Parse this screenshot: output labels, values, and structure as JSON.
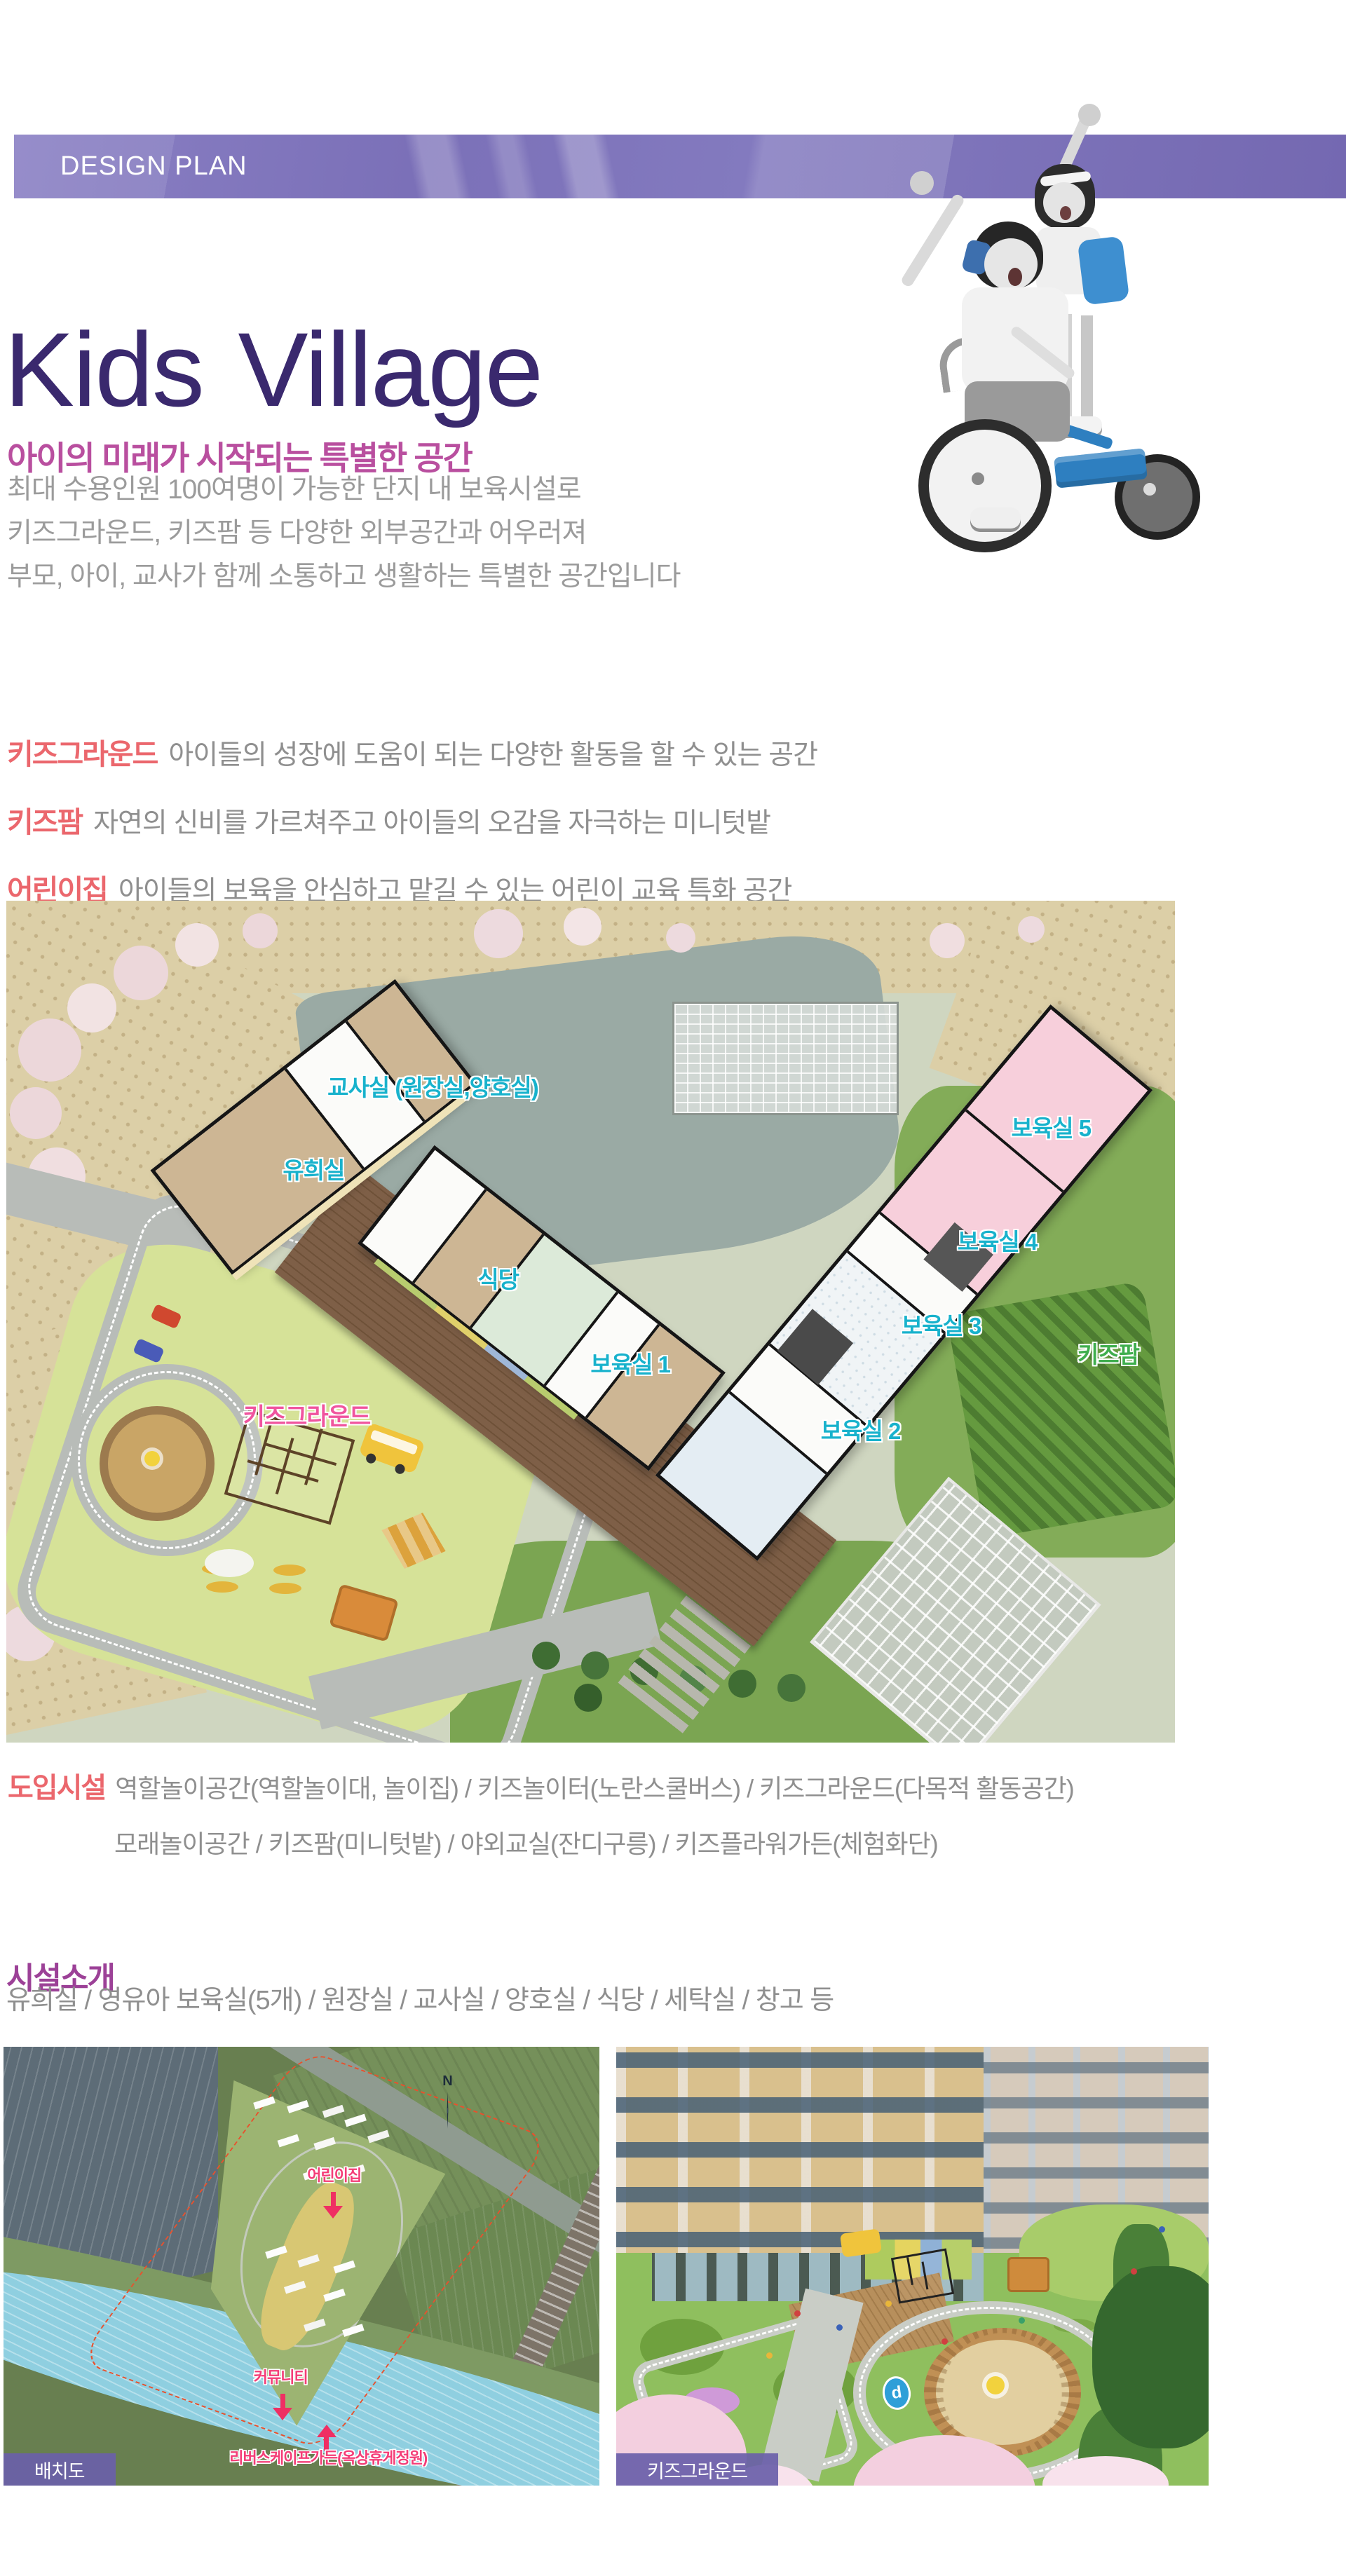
{
  "banner": {
    "label": "DESIGN PLAN"
  },
  "hero": {
    "title": "Kids Village",
    "subtitle": "아이의 미래가 시작되는 특별한 공간",
    "body_lines": [
      "최대 수용인원 100여명이 가능한 단지 내 보육시설로",
      "키즈그라운드, 키즈팜 등 다양한 외부공간과 어우러져",
      "부모, 아이, 교사가 함께 소통하고 생활하는 특별한 공간입니다"
    ]
  },
  "features": [
    {
      "label": "키즈그라운드",
      "desc": "아이들의 성장에 도움이 되는 다양한 활동을 할 수 있는 공간"
    },
    {
      "label": "키즈팜",
      "desc": "자연의 신비를 가르쳐주고 아이들의 오감을 자극하는 미니텃밭"
    },
    {
      "label": "어린이집",
      "desc": "아이들의 보육을 안심하고 맡길 수 있는 어린이 교육 특화 공간"
    }
  ],
  "floor_plan": {
    "labels": {
      "teachers_room": "교사실 (원장실,양호실)",
      "play_room": "유희실",
      "nursery5": "보육실 5",
      "nursery4": "보육실 4",
      "nursery3": "보육실 3",
      "kids_farm": "키즈팜",
      "dining": "식당",
      "nursery1": "보육실 1",
      "nursery2": "보육실 2",
      "kids_ground": "키즈그라운드"
    }
  },
  "intro_facilities": {
    "label": "도입시설",
    "line1": "역할놀이공간(역할놀이대, 놀이집) / 키즈놀이터(노란스쿨버스) / 키즈그라운드(다목적 활동공간)",
    "line2": "모래놀이공간 / 키즈팜(미니텃밭) / 야외교실(잔디구릉) / 키즈플라워가든(체험화단)"
  },
  "facility_intro": {
    "title": "시설소개",
    "body": "유희실 / 영유아 보육실(5개) / 원장실 / 교사실 / 양호실 / 식당 / 세탁실 / 창고 등"
  },
  "site_plan": {
    "badge": "배치도",
    "compass": "N",
    "labels": {
      "daycare": "어린이집",
      "community": "커뮤니티",
      "riverscape": "리버스케이프가든(옥상휴게정원)"
    }
  },
  "playground_image": {
    "badge": "키즈그라운드",
    "sign": "d"
  },
  "colors": {
    "banner_purple": "#7b70b8",
    "title_purple": "#3a296e",
    "subtitle_pink": "#b94f9f",
    "body_gray": "#9b9b9b",
    "feature_label_coral": "#eb676d",
    "plan_label_cyan": "#18b2cc",
    "plan_label_green": "#3fae4e",
    "plan_label_pink": "#f0549e",
    "site_label_pink": "#f43d77",
    "section_title_purple": "#9c4197",
    "badge_purple": "#6a5fa9",
    "tricycle_blue": "#2e7fc0"
  }
}
